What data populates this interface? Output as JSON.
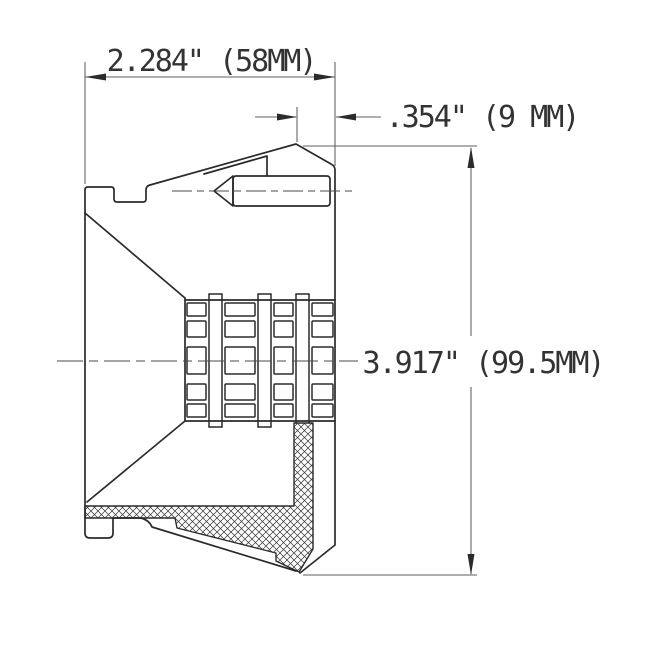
{
  "drawing": {
    "type": "technical-cross-section",
    "dimensions": {
      "width": {
        "label": "2.284\" (58MM)"
      },
      "offset": {
        "label": ".354\" (9 MM)"
      },
      "height": {
        "label": "3.917\" (99.5MM)"
      }
    },
    "colors": {
      "background": "#ffffff",
      "object_line": "#2b2b2b",
      "thin_line": "#5f5f5f",
      "centerline": "#4a4a4a",
      "text": "#333333"
    },
    "grid": {
      "top": 300,
      "bottom": 421,
      "left": 185,
      "right": 335,
      "tab_top": 294,
      "tab_bottom": 427,
      "ribs": [
        [
          209,
          222
        ],
        [
          258,
          271
        ],
        [
          296,
          309
        ]
      ],
      "cols": [
        [
          187,
          206
        ],
        [
          225,
          255
        ],
        [
          274,
          293
        ],
        [
          312,
          333
        ]
      ],
      "rows": [
        [
          303,
          316
        ],
        [
          321,
          337
        ],
        [
          347,
          374
        ],
        [
          384,
          400
        ],
        [
          404,
          417
        ]
      ]
    }
  }
}
